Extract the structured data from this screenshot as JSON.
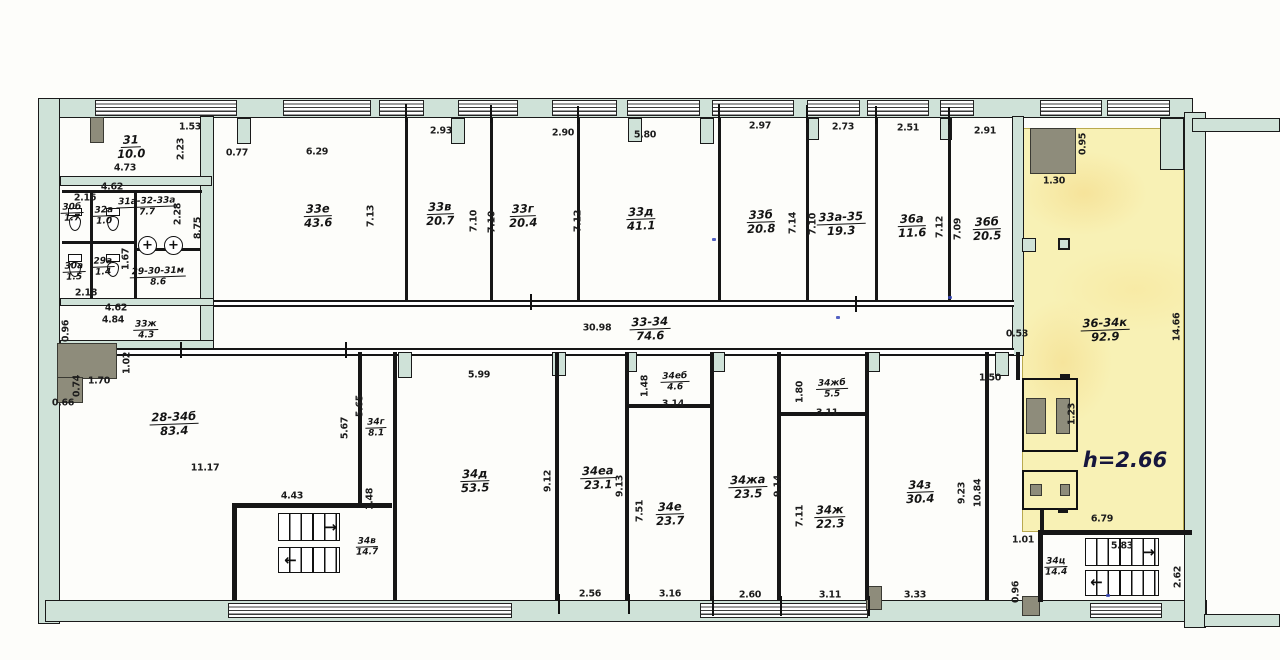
{
  "drawing": {
    "type": "floor-plan",
    "highlight_color": "#f8f1b5",
    "wall_color": "#cfe2d8",
    "line_color": "#1a1a1a"
  },
  "icons": {
    "basin_glyph": "+",
    "stair_arrow_right": "→",
    "stair_arrow_left": "←"
  },
  "labels": {
    "rooms": [
      {
        "n": "31",
        "a": "10.0",
        "x": 131,
        "y": 147
      },
      {
        "n": "30б",
        "a": "1.7",
        "x": 72,
        "y": 213,
        "s": 1
      },
      {
        "n": "32а",
        "a": "1.0",
        "x": 104,
        "y": 216,
        "s": 1
      },
      {
        "n": "31а-32-33а",
        "a": "7.7",
        "x": 147,
        "y": 207,
        "s": 1
      },
      {
        "n": "30а",
        "a": "1.5",
        "x": 74,
        "y": 272,
        "s": 1
      },
      {
        "n": "29а",
        "a": "1.4",
        "x": 103,
        "y": 267,
        "s": 1
      },
      {
        "n": "29-30-31м",
        "a": "8.6",
        "x": 158,
        "y": 277,
        "s": 1
      },
      {
        "n": "33ж",
        "a": "4.3",
        "x": 146,
        "y": 330,
        "s": 1
      },
      {
        "n": "33е",
        "a": "43.6",
        "x": 318,
        "y": 216
      },
      {
        "n": "33в",
        "a": "20.7",
        "x": 440,
        "y": 214
      },
      {
        "n": "33г",
        "a": "20.4",
        "x": 523,
        "y": 216
      },
      {
        "n": "33д",
        "a": "41.1",
        "x": 641,
        "y": 219
      },
      {
        "n": "33б",
        "a": "20.8",
        "x": 761,
        "y": 222
      },
      {
        "n": "33а-35",
        "a": "19.3",
        "x": 841,
        "y": 224
      },
      {
        "n": "36а",
        "a": "11.6",
        "x": 912,
        "y": 226
      },
      {
        "n": "36б",
        "a": "20.5",
        "x": 987,
        "y": 229
      },
      {
        "n": "33-34",
        "a": "74.6",
        "x": 650,
        "y": 329
      },
      {
        "n": "36-34к",
        "a": "92.9",
        "x": 1105,
        "y": 330
      },
      {
        "n": "28-34б",
        "a": "83.4",
        "x": 174,
        "y": 424
      },
      {
        "n": "34г",
        "a": "8.1",
        "x": 376,
        "y": 428,
        "s": 1
      },
      {
        "n": "34в",
        "a": "14.7",
        "x": 367,
        "y": 547,
        "s": 1
      },
      {
        "n": "34д",
        "a": "53.5",
        "x": 475,
        "y": 481
      },
      {
        "n": "34еа",
        "a": "23.1",
        "x": 598,
        "y": 478
      },
      {
        "n": "34еб",
        "a": "4.6",
        "x": 675,
        "y": 382,
        "s": 1
      },
      {
        "n": "34е",
        "a": "23.7",
        "x": 670,
        "y": 514
      },
      {
        "n": "34жа",
        "a": "23.5",
        "x": 748,
        "y": 487
      },
      {
        "n": "34жб",
        "a": "5.5",
        "x": 832,
        "y": 389,
        "s": 1
      },
      {
        "n": "34ж",
        "a": "22.3",
        "x": 830,
        "y": 517
      },
      {
        "n": "34з",
        "a": "30.4",
        "x": 920,
        "y": 492
      },
      {
        "n": "34ц",
        "a": "14.4",
        "x": 1056,
        "y": 567,
        "s": 1
      }
    ],
    "dims": [
      {
        "t": "1.53",
        "x": 190,
        "y": 127
      },
      {
        "t": "0.77",
        "x": 237,
        "y": 153
      },
      {
        "t": "6.29",
        "x": 317,
        "y": 152
      },
      {
        "t": "2.93",
        "x": 441,
        "y": 131
      },
      {
        "t": "2.90",
        "x": 563,
        "y": 133
      },
      {
        "t": "5.80",
        "x": 645,
        "y": 135
      },
      {
        "t": "2.97",
        "x": 760,
        "y": 126
      },
      {
        "t": "2.73",
        "x": 843,
        "y": 127
      },
      {
        "t": "2.51",
        "x": 908,
        "y": 128
      },
      {
        "t": "2.91",
        "x": 985,
        "y": 131
      },
      {
        "t": "1.30",
        "x": 1054,
        "y": 181
      },
      {
        "t": "0.95",
        "x": 1083,
        "y": 144,
        "v": 1
      },
      {
        "t": "2.23",
        "x": 181,
        "y": 149,
        "v": 1
      },
      {
        "t": "4.73",
        "x": 125,
        "y": 168
      },
      {
        "t": "4.62",
        "x": 112,
        "y": 187
      },
      {
        "t": "2.16",
        "x": 85,
        "y": 198
      },
      {
        "t": "2.28",
        "x": 178,
        "y": 214,
        "v": 1
      },
      {
        "t": "8.75",
        "x": 198,
        "y": 228,
        "v": 1
      },
      {
        "t": "1.67",
        "x": 126,
        "y": 259,
        "v": 1
      },
      {
        "t": "2.18",
        "x": 86,
        "y": 293
      },
      {
        "t": "4.62",
        "x": 116,
        "y": 308
      },
      {
        "t": "4.84",
        "x": 113,
        "y": 320
      },
      {
        "t": "0.96",
        "x": 66,
        "y": 331,
        "v": 1
      },
      {
        "t": "7.13",
        "x": 371,
        "y": 216,
        "v": 1
      },
      {
        "t": "7.10",
        "x": 474,
        "y": 221,
        "v": 1
      },
      {
        "t": "7.10",
        "x": 492,
        "y": 222,
        "v": 1
      },
      {
        "t": "7.12",
        "x": 578,
        "y": 221,
        "v": 1
      },
      {
        "t": "7.14",
        "x": 793,
        "y": 223,
        "v": 1
      },
      {
        "t": "7.10",
        "x": 813,
        "y": 224,
        "v": 1
      },
      {
        "t": "7.12",
        "x": 940,
        "y": 227,
        "v": 1
      },
      {
        "t": "7.09",
        "x": 958,
        "y": 229,
        "v": 1
      },
      {
        "t": "30.98",
        "x": 597,
        "y": 328
      },
      {
        "t": "0.53",
        "x": 1017,
        "y": 334
      },
      {
        "t": "14.66",
        "x": 1177,
        "y": 327,
        "v": 1
      },
      {
        "t": "1.02",
        "x": 127,
        "y": 363,
        "v": 1
      },
      {
        "t": "1.70",
        "x": 99,
        "y": 381
      },
      {
        "t": "0.74",
        "x": 77,
        "y": 386,
        "v": 1
      },
      {
        "t": "0.66",
        "x": 63,
        "y": 403
      },
      {
        "t": "5.99",
        "x": 479,
        "y": 375
      },
      {
        "t": "1.50",
        "x": 990,
        "y": 378
      },
      {
        "t": "1.23",
        "x": 1072,
        "y": 414,
        "v": 1
      },
      {
        "t": "5.65",
        "x": 360,
        "y": 406,
        "v": 1
      },
      {
        "t": "5.67",
        "x": 345,
        "y": 428,
        "v": 1
      },
      {
        "t": "11.17",
        "x": 205,
        "y": 468
      },
      {
        "t": "4.43",
        "x": 292,
        "y": 496
      },
      {
        "t": "1.48",
        "x": 370,
        "y": 499,
        "v": 1
      },
      {
        "t": "9.12",
        "x": 548,
        "y": 481,
        "v": 1
      },
      {
        "t": "9.13",
        "x": 620,
        "y": 486,
        "v": 1
      },
      {
        "t": "1.48",
        "x": 645,
        "y": 386,
        "v": 1
      },
      {
        "t": "3.14",
        "x": 673,
        "y": 404
      },
      {
        "t": "7.51",
        "x": 640,
        "y": 511,
        "v": 1
      },
      {
        "t": "9.14",
        "x": 778,
        "y": 486,
        "v": 1
      },
      {
        "t": "1.80",
        "x": 800,
        "y": 392,
        "v": 1
      },
      {
        "t": "3.11",
        "x": 827,
        "y": 413
      },
      {
        "t": "7.11",
        "x": 800,
        "y": 516,
        "v": 1
      },
      {
        "t": "9.23",
        "x": 962,
        "y": 493,
        "v": 1
      },
      {
        "t": "10.84",
        "x": 978,
        "y": 493,
        "v": 1
      },
      {
        "t": "6.79",
        "x": 1102,
        "y": 519
      },
      {
        "t": "1.01",
        "x": 1023,
        "y": 540
      },
      {
        "t": "5.83",
        "x": 1122,
        "y": 546
      },
      {
        "t": "2.62",
        "x": 1178,
        "y": 577,
        "v": 1
      },
      {
        "t": "2.56",
        "x": 590,
        "y": 594
      },
      {
        "t": "3.16",
        "x": 670,
        "y": 594
      },
      {
        "t": "2.60",
        "x": 750,
        "y": 595
      },
      {
        "t": "3.11",
        "x": 830,
        "y": 595
      },
      {
        "t": "3.33",
        "x": 915,
        "y": 595
      },
      {
        "t": "0.96",
        "x": 1016,
        "y": 592,
        "v": 1
      }
    ],
    "notes": [
      {
        "t": "h=2.66",
        "x": 1125,
        "y": 460
      }
    ]
  }
}
